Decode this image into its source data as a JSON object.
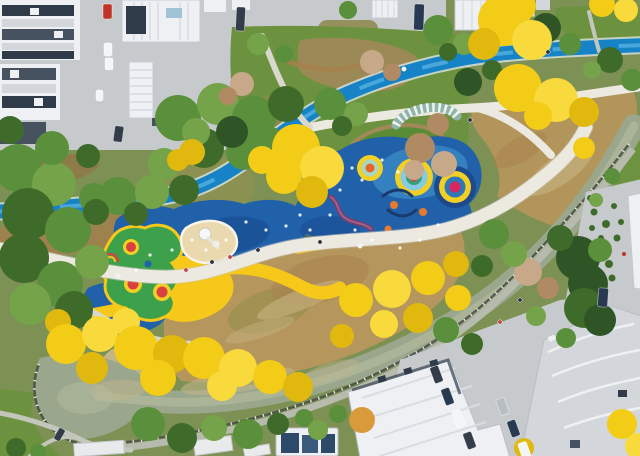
{
  "scene": {
    "title": "Aerial view of riverside park with colorful playground",
    "description": "Drone photo of an urban pocket park in autumn: a blue cycle greenway and white footpaths wind between golden trees, a playground with concentric-circle mounds on blue rubber surfacing, a winding canal with stone embankments, lawns, and surrounding white residential buildings with parked cars.",
    "features": [
      "residential buildings",
      "parking areas with cars",
      "blue cycle greenway",
      "white pedestrian promenade",
      "riverside walk",
      "playground concentric circle mounds",
      "blue rubber safety surface",
      "yellow surface bands",
      "green play blob with trampolines",
      "sand pit",
      "purple balance wall",
      "climbing arcs",
      "canal with stone embankment",
      "pond bend",
      "autumn yellow trees",
      "evergreen trees",
      "meadow slope",
      "pergola arc",
      "pedestrians"
    ],
    "trees": [
      [
        18,
        168,
        24,
        "g1"
      ],
      [
        54,
        184,
        22,
        "g3"
      ],
      [
        28,
        214,
        26,
        "g2"
      ],
      [
        68,
        230,
        23,
        "g1"
      ],
      [
        24,
        258,
        25,
        "g2"
      ],
      [
        60,
        284,
        23,
        "g1"
      ],
      [
        30,
        304,
        21,
        "g3"
      ],
      [
        74,
        310,
        19,
        "g2"
      ],
      [
        52,
        148,
        17,
        "g1"
      ],
      [
        92,
        262,
        17,
        "g3"
      ],
      [
        94,
        198,
        15,
        "g1"
      ],
      [
        88,
        156,
        12,
        "g2"
      ],
      [
        10,
        130,
        14,
        "g2"
      ],
      [
        118,
        196,
        19,
        "g1"
      ],
      [
        152,
        192,
        17,
        "g3"
      ],
      [
        184,
        190,
        15,
        "g2"
      ],
      [
        96,
        212,
        13,
        "g2"
      ],
      [
        136,
        214,
        12,
        "g2"
      ],
      [
        178,
        118,
        23,
        "g1"
      ],
      [
        218,
        104,
        21,
        "g3"
      ],
      [
        254,
        118,
        22,
        "g1"
      ],
      [
        286,
        104,
        18,
        "g2"
      ],
      [
        204,
        148,
        20,
        "g2"
      ],
      [
        244,
        152,
        18,
        "g1"
      ],
      [
        164,
        164,
        16,
        "g3"
      ],
      [
        270,
        142,
        15,
        "g1"
      ],
      [
        232,
        132,
        16,
        "g4"
      ],
      [
        196,
        132,
        14,
        "g3"
      ],
      [
        330,
        104,
        16,
        "g1"
      ],
      [
        356,
        114,
        12,
        "g3"
      ],
      [
        342,
        126,
        10,
        "g2"
      ],
      [
        258,
        44,
        11,
        "g3"
      ],
      [
        284,
        54,
        9,
        "g1"
      ],
      [
        438,
        30,
        15,
        "g1"
      ],
      [
        464,
        44,
        11,
        "g3"
      ],
      [
        448,
        52,
        9,
        "g2"
      ],
      [
        348,
        10,
        9,
        "g1"
      ],
      [
        546,
        28,
        15,
        "g4"
      ],
      [
        570,
        44,
        11,
        "g1"
      ],
      [
        610,
        60,
        13,
        "g2"
      ],
      [
        632,
        80,
        11,
        "g1"
      ],
      [
        592,
        70,
        9,
        "g3"
      ],
      [
        242,
        84,
        12,
        "a2"
      ],
      [
        228,
        96,
        9,
        "a"
      ],
      [
        372,
        62,
        12,
        "a2"
      ],
      [
        392,
        72,
        9,
        "a"
      ],
      [
        420,
        148,
        15,
        "a"
      ],
      [
        444,
        164,
        13,
        "a2"
      ],
      [
        438,
        124,
        11,
        "a"
      ],
      [
        414,
        170,
        10,
        "a2"
      ],
      [
        468,
        82,
        14,
        "g4"
      ],
      [
        492,
        70,
        10,
        "g2"
      ],
      [
        528,
        272,
        14,
        "a2"
      ],
      [
        548,
        288,
        11,
        "a"
      ],
      [
        494,
        234,
        15,
        "g1"
      ],
      [
        514,
        254,
        13,
        "g3"
      ],
      [
        482,
        266,
        11,
        "g2"
      ],
      [
        578,
        258,
        22,
        "g4"
      ],
      [
        588,
        284,
        20,
        "g4"
      ],
      [
        584,
        308,
        20,
        "g2"
      ],
      [
        600,
        320,
        16,
        "g4"
      ],
      [
        560,
        238,
        13,
        "g2"
      ],
      [
        600,
        250,
        12,
        "g1"
      ],
      [
        566,
        338,
        10,
        "g1"
      ],
      [
        536,
        316,
        10,
        "g3"
      ],
      [
        148,
        424,
        17,
        "g1"
      ],
      [
        182,
        438,
        15,
        "g2"
      ],
      [
        214,
        428,
        13,
        "g3"
      ],
      [
        248,
        434,
        15,
        "g1"
      ],
      [
        278,
        424,
        11,
        "g2"
      ],
      [
        304,
        418,
        9,
        "g1"
      ],
      [
        446,
        330,
        13,
        "g1"
      ],
      [
        472,
        344,
        11,
        "g2"
      ],
      [
        318,
        430,
        10,
        "g3"
      ],
      [
        338,
        414,
        9,
        "g1"
      ],
      [
        16,
        448,
        10,
        "g2"
      ],
      [
        38,
        452,
        8,
        "g1"
      ],
      [
        612,
        176,
        8,
        "g1"
      ],
      [
        596,
        200,
        7,
        "g3"
      ],
      [
        178,
        160,
        11,
        "y2"
      ],
      [
        192,
        152,
        13,
        "y2"
      ],
      [
        296,
        148,
        24,
        "y1"
      ],
      [
        322,
        168,
        22,
        "y3"
      ],
      [
        284,
        176,
        18,
        "y1"
      ],
      [
        312,
        192,
        16,
        "y2"
      ],
      [
        262,
        160,
        14,
        "y1"
      ],
      [
        504,
        20,
        26,
        "y1"
      ],
      [
        532,
        40,
        20,
        "y3"
      ],
      [
        484,
        44,
        16,
        "y2"
      ],
      [
        520,
        6,
        16,
        "y1"
      ],
      [
        518,
        88,
        24,
        "y1"
      ],
      [
        556,
        100,
        22,
        "y3"
      ],
      [
        584,
        112,
        15,
        "y2"
      ],
      [
        538,
        116,
        14,
        "y1"
      ],
      [
        584,
        148,
        11,
        "y1"
      ],
      [
        602,
        4,
        13,
        "y1"
      ],
      [
        626,
        10,
        12,
        "y3"
      ],
      [
        58,
        322,
        13,
        "y2"
      ],
      [
        66,
        344,
        20,
        "y1"
      ],
      [
        100,
        334,
        18,
        "y3"
      ],
      [
        126,
        322,
        14,
        "y3"
      ],
      [
        136,
        348,
        22,
        "y1"
      ],
      [
        172,
        354,
        19,
        "y2"
      ],
      [
        204,
        358,
        21,
        "y1"
      ],
      [
        238,
        368,
        19,
        "y3"
      ],
      [
        270,
        377,
        17,
        "y1"
      ],
      [
        298,
        387,
        15,
        "y2"
      ],
      [
        92,
        368,
        16,
        "y2"
      ],
      [
        158,
        378,
        18,
        "y1"
      ],
      [
        222,
        386,
        15,
        "y3"
      ],
      [
        356,
        300,
        17,
        "y1"
      ],
      [
        392,
        289,
        19,
        "y3"
      ],
      [
        428,
        278,
        17,
        "y1"
      ],
      [
        456,
        264,
        13,
        "y2"
      ],
      [
        418,
        318,
        15,
        "y2"
      ],
      [
        458,
        298,
        13,
        "y1"
      ],
      [
        384,
        324,
        14,
        "y3"
      ],
      [
        342,
        336,
        12,
        "y2"
      ],
      [
        622,
        424,
        15,
        "y1"
      ],
      [
        638,
        446,
        13,
        "y3"
      ],
      [
        362,
        420,
        13,
        "o"
      ],
      [
        524,
        448,
        10,
        "y2"
      ]
    ],
    "cars": [
      [
        103,
        4,
        9,
        15,
        0,
        "red"
      ],
      [
        104,
        43,
        8,
        13,
        0,
        "white"
      ],
      [
        105,
        58,
        8,
        12,
        0,
        "white"
      ],
      [
        114,
        126,
        9,
        16,
        8,
        "dark"
      ],
      [
        236,
        7,
        9,
        24,
        3,
        "dark"
      ],
      [
        414,
        4,
        10,
        26,
        2,
        "navy"
      ],
      [
        96,
        90,
        7,
        11,
        0,
        "white"
      ],
      [
        432,
        366,
        9,
        17,
        -20,
        "dark"
      ],
      [
        443,
        388,
        9,
        17,
        -20,
        "navy"
      ],
      [
        454,
        410,
        9,
        17,
        -20,
        "white"
      ],
      [
        465,
        432,
        9,
        17,
        -20,
        "dark"
      ],
      [
        498,
        398,
        9,
        17,
        -20,
        "silver"
      ],
      [
        509,
        420,
        9,
        17,
        -20,
        "navy"
      ],
      [
        520,
        442,
        9,
        17,
        -20,
        "white"
      ],
      [
        598,
        288,
        10,
        19,
        4,
        "navy"
      ],
      [
        56,
        428,
        7,
        13,
        30,
        "dark"
      ]
    ],
    "people": [
      [
        212,
        262,
        "#2e3440"
      ],
      [
        230,
        257,
        "#c04743"
      ],
      [
        118,
        276,
        "#f2f2f2"
      ],
      [
        258,
        250,
        "#2e3440"
      ],
      [
        404,
        69,
        "#f2f2f2"
      ],
      [
        548,
        52,
        "#2e3440"
      ],
      [
        186,
        270,
        "#c04743"
      ],
      [
        320,
        242,
        "#2e3440"
      ],
      [
        470,
        120,
        "#2e3440"
      ],
      [
        360,
        246,
        "#f2f2f2"
      ],
      [
        520,
        300,
        "#2e3440"
      ],
      [
        500,
        322,
        "#c04743"
      ]
    ],
    "speckles": [
      [
        352,
        168
      ],
      [
        362,
        180
      ],
      [
        340,
        190
      ],
      [
        300,
        215
      ],
      [
        286,
        226
      ],
      [
        310,
        230
      ],
      [
        266,
        230
      ],
      [
        246,
        222
      ],
      [
        226,
        240
      ],
      [
        206,
        250
      ],
      [
        192,
        240
      ],
      [
        172,
        250
      ],
      [
        438,
        225
      ],
      [
        420,
        240
      ],
      [
        400,
        248
      ],
      [
        372,
        240
      ],
      [
        330,
        215
      ],
      [
        355,
        230
      ],
      [
        150,
        255
      ],
      [
        136,
        270
      ],
      [
        382,
        160
      ],
      [
        398,
        172
      ]
    ]
  },
  "palette": {
    "base": "#7d9154",
    "pavement": "#c7cacd",
    "pavement_dark": "#b8bcc0",
    "building_white": "#eef0f3",
    "building_gray": "#d3d6da",
    "roof_slate": "#46525f",
    "roof_slate_dark": "#2f3b48",
    "roof_ridge": "#dde0e4",
    "glass_blue": "#9fc3d4",
    "lawn_green": "#6d923f",
    "lawn_bright": "#5a8c36",
    "lawn_olive": "#8f8a52",
    "lawn_tan": "#a3885a",
    "meadow_tan": "#b5965c",
    "meadow_olive": "#97914f",
    "meadow_brown": "#a87e4c",
    "meadow_pale": "#cbb98a",
    "water": "#9aa78d",
    "water_light": "#b4bb9d",
    "water_tan": "#c4b68c",
    "wall_dark": "#4c5148",
    "bank_path": "#b7bbae",
    "post_light": "#e4e8dc",
    "greenway": "#1583c5",
    "greenway_light": "#54aede",
    "greenway_edge": "#dfe9ee",
    "path_white": "#ece9e0",
    "path_shadow": "#c9c6bb",
    "path_minor": "#d9d8cf",
    "path_thin": "#c3c6ba",
    "pg_blue": "#2161a9",
    "pg_blue_dark": "#174a8e",
    "pg_blue_light": "#4a9fd4",
    "pg_yellow": "#f5c81a",
    "pg_green": "#3da14c",
    "sand": "#ead9ae",
    "sand_rim": "#f8f4ea",
    "ring_yellow": "#f2cf25",
    "ring_cyan": "#86cbe4",
    "ring_teal": "#3a9e77",
    "ring_mint": "#a8d8c0",
    "ring_navy": "#1d4a8c",
    "ring_blue": "#2e77b8",
    "ring_red": "#e03a55",
    "ring_crimson": "#d9275e",
    "ring_orange": "#e8642e",
    "dot_orange": "#e87a2e",
    "wall_purple": "#7c3f6d",
    "wall_purple_hi": "#b07aa2",
    "climber_navy": "#1a3a6e",
    "pergola_teal": "#8fb4a8",
    "tree_y1": "#f2cc16",
    "tree_y2": "#e0b80e",
    "tree_y3": "#f8da3c",
    "tree_g1": "#5a8f3b",
    "tree_g2": "#3f6b2a",
    "tree_g3": "#74a34a",
    "tree_g4": "#2f5526",
    "tree_a": "#b08a62",
    "tree_a2": "#c7a98a",
    "tree_o": "#d99a3c",
    "car_red": "#c03527",
    "car_white": "#f4f5f6",
    "car_dark": "#333d4a",
    "car_navy": "#273a52",
    "car_silver": "#b9bec4",
    "rust": "#9a6b42"
  }
}
